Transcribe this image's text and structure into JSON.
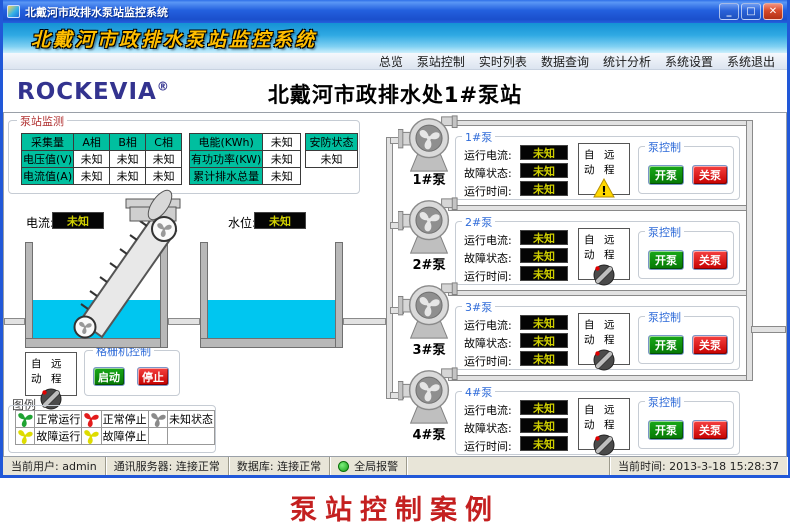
{
  "window": {
    "titlebar": {
      "title": "北戴河市政排水泵站监控系统"
    },
    "banner": "北戴河市政排水泵站监控系统",
    "menu": [
      "总览",
      "泵站控制",
      "实时列表",
      "数据查询",
      "统计分析",
      "系统设置",
      "系统退出"
    ],
    "logo": {
      "brand": "ROCKEVIA",
      "reg": "®"
    },
    "page_title": "北戴河市政排水处1#泵站"
  },
  "icons": {
    "minimize": "_",
    "maximize": "□",
    "close": "✕"
  },
  "monitor": {
    "title": "泵站监测",
    "phase_table": {
      "headers": [
        "采集量",
        "A相",
        "B相",
        "C相"
      ],
      "rows": [
        {
          "label": "电压值(V)",
          "v1": "未知",
          "v2": "未知",
          "v3": "未知"
        },
        {
          "label": "电流值(A)",
          "v1": "未知",
          "v2": "未知",
          "v3": "未知"
        }
      ]
    },
    "energy_rows": [
      {
        "label": "电能(KWh)",
        "value": "未知"
      },
      {
        "label": "有功功率(KW)",
        "value": "未知"
      },
      {
        "label": "累计排水总量",
        "value": "未知"
      }
    ],
    "security": {
      "header": "安防状态",
      "value": "未知"
    }
  },
  "scene": {
    "current_label": "电流:",
    "current_value": "未知",
    "level_label": "水位:",
    "level_value": "未知"
  },
  "grid_machine": {
    "switch": {
      "auto": "自动",
      "remote": "远程"
    },
    "control": {
      "title": "格栅机控制",
      "start": "启动",
      "stop": "停止"
    }
  },
  "legend": {
    "title": "图例",
    "items": [
      {
        "label": "正常运行",
        "color": "#1FA332"
      },
      {
        "label": "正常停止",
        "color": "#E31B1B"
      },
      {
        "label": "未知状态",
        "color": "#8A8A8A"
      },
      {
        "label": "故障运行",
        "color": "#DEDC00"
      },
      {
        "label": "故障停止",
        "color": "#DEDC00"
      }
    ]
  },
  "pumps": [
    {
      "name": "1#泵",
      "panel_title": "1#泵",
      "indicator": "warning",
      "fields": {
        "current_label": "运行电流:",
        "current_value": "未知",
        "fault_label": "故障状态:",
        "fault_value": "未知",
        "runtime_label": "运行时间:",
        "runtime_value": "未知"
      },
      "switch": {
        "auto": "自动",
        "remote": "远程"
      },
      "control": {
        "title": "泵控制",
        "on": "开泵",
        "off": "关泵"
      }
    },
    {
      "name": "2#泵",
      "panel_title": "2#泵",
      "indicator": "knob",
      "fields": {
        "current_label": "运行电流:",
        "current_value": "未知",
        "fault_label": "故障状态:",
        "fault_value": "未知",
        "runtime_label": "运行时间:",
        "runtime_value": "未知"
      },
      "switch": {
        "auto": "自动",
        "remote": "远程"
      },
      "control": {
        "title": "泵控制",
        "on": "开泵",
        "off": "关泵"
      }
    },
    {
      "name": "3#泵",
      "panel_title": "3#泵",
      "indicator": "knob",
      "fields": {
        "current_label": "运行电流:",
        "current_value": "未知",
        "fault_label": "故障状态:",
        "fault_value": "未知",
        "runtime_label": "运行时间:",
        "runtime_value": "未知"
      },
      "switch": {
        "auto": "自动",
        "remote": "远程"
      },
      "control": {
        "title": "泵控制",
        "on": "开泵",
        "off": "关泵"
      }
    },
    {
      "name": "4#泵",
      "panel_title": "4#泵",
      "indicator": "knob",
      "fields": {
        "current_label": "运行电流:",
        "current_value": "未知",
        "fault_label": "故障状态:",
        "fault_value": "未知",
        "runtime_label": "运行时间:",
        "runtime_value": "未知"
      },
      "switch": {
        "auto": "自动",
        "remote": "远程"
      },
      "control": {
        "title": "泵控制",
        "on": "开泵",
        "off": "关泵"
      }
    }
  ],
  "statusbar": {
    "user_label": "当前用户:",
    "user_value": "admin",
    "comm_label": "通讯服务器:",
    "comm_value": "连接正常",
    "db_label": "数据库:",
    "db_value": "连接正常",
    "alarm_label": "全局报警",
    "time_label": "当前时间:",
    "time_value": "2013-3-18 15:28:37"
  },
  "caption": "泵站控制案例",
  "colors": {
    "teal_header": "#00BF9F",
    "value_bg": "#050505",
    "value_text": "#CFCF00",
    "button_green": "#0E8A12",
    "button_red": "#D60000",
    "water": "#00C6F0",
    "group_caption_blue": "#2F6BD8",
    "monitor_caption_red": "#B03030",
    "banner_text": "#FFBE00",
    "caption_red": "#C42020",
    "alarm_ok_green": "#18A018"
  }
}
